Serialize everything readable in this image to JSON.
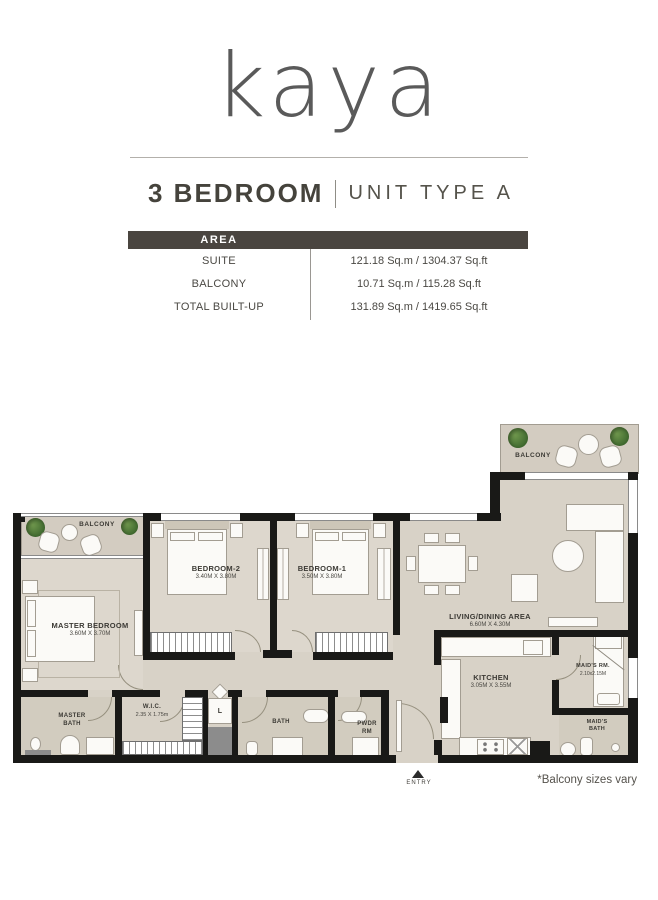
{
  "logo": "kaya",
  "title": {
    "main": "3 BEDROOM",
    "sub": "UNIT TYPE A"
  },
  "area_table": {
    "header": "AREA",
    "rows": [
      {
        "label": "SUITE",
        "value": "121.18 Sq.m / 1304.37 Sq.ft"
      },
      {
        "label": "BALCONY",
        "value": "10.71 Sq.m / 115.28 Sq.ft"
      },
      {
        "label": "TOTAL BUILT-UP",
        "value": "131.89 Sq.m / 1419.65 Sq.ft"
      }
    ]
  },
  "floorplan": {
    "balcony_top": "BALCONY",
    "balcony_left": "BALCONY",
    "rooms": {
      "master_bedroom": {
        "name": "MASTER BEDROOM",
        "dims": "3.60M X 3.70M"
      },
      "bedroom2": {
        "name": "BEDROOM-2",
        "dims": "3.40M X 3.80M"
      },
      "bedroom1": {
        "name": "BEDROOM-1",
        "dims": "3.50M X 3.80M"
      },
      "living": {
        "name": "LIVING/DINING AREA",
        "dims": "6.60M X 4.30M"
      },
      "kitchen": {
        "name": "KITCHEN",
        "dims": "3.05M X 3.55M"
      },
      "maids_rm": {
        "name": "MAID'S RM.",
        "dims": "2.10x2.15M"
      },
      "maids_bath": {
        "line1": "MAID'S",
        "line2": "BATH"
      },
      "master_bath": {
        "line1": "MASTER",
        "line2": "BATH"
      },
      "wic": {
        "name": "W.I.C.",
        "dims": "2.35 X 1.75m"
      },
      "bath": {
        "name": "BATH"
      },
      "pwdr": {
        "line1": "PWDR",
        "line2": "RM"
      },
      "laundry": {
        "name": "L"
      }
    },
    "entry": "ENTRY",
    "note": "*Balcony sizes vary"
  },
  "colors": {
    "accent_bar": "#4a4540",
    "wall": "#191917",
    "floor": "#d8d2c7"
  }
}
